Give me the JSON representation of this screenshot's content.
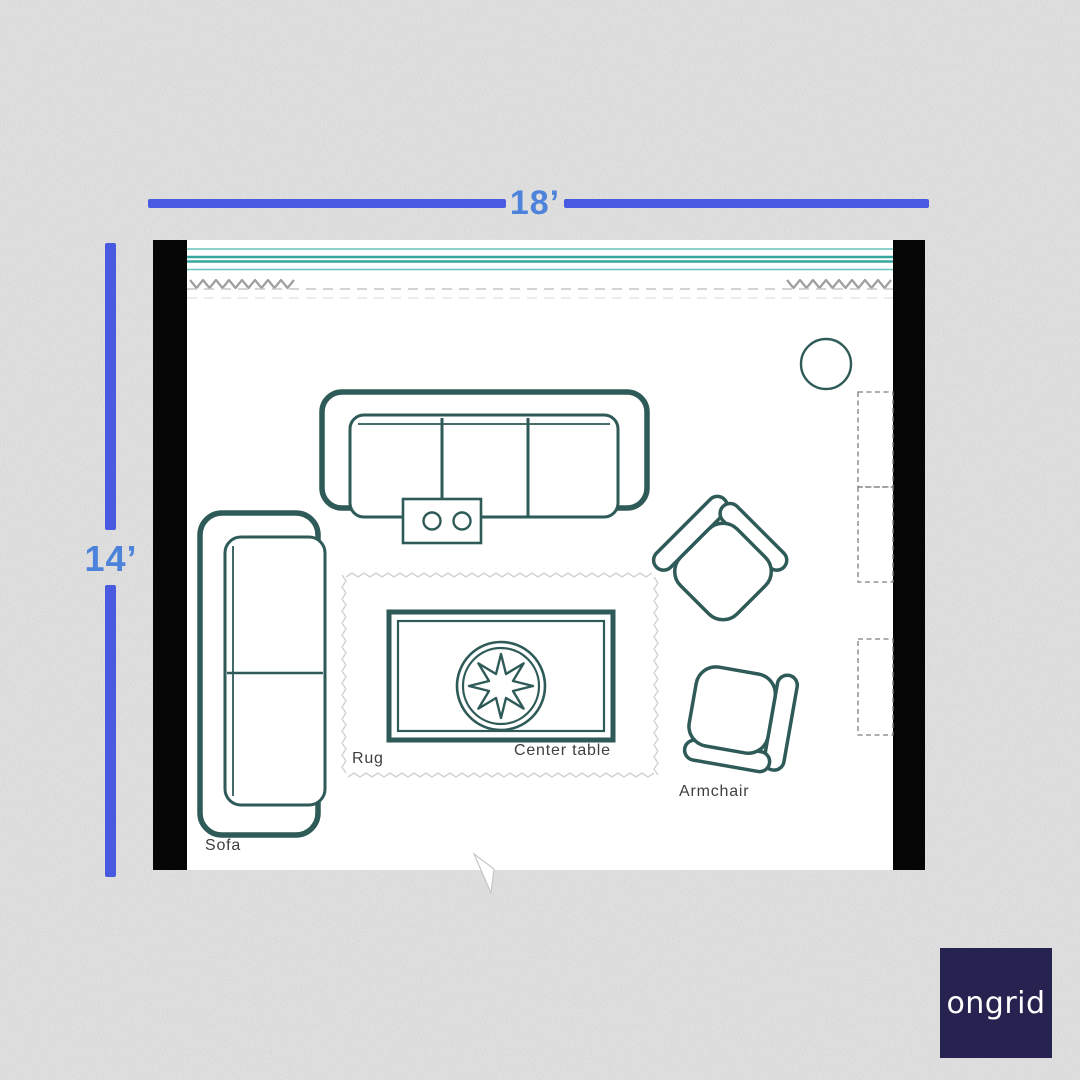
{
  "poster": {
    "dimension_labels": {
      "width": "18’",
      "height": "14’"
    },
    "room_labels": {
      "sofa": "Sofa",
      "rug": "Rug",
      "center_table": "Center table",
      "armchair": "Armchair"
    },
    "logo": {
      "text": "ongrid"
    },
    "colors": {
      "background": "#e3e3e3",
      "dimension_bar": "#4a5ae0",
      "dimension_text": "#4d83da",
      "furniture_outline": "#2e5a57",
      "window_glass_dark": "#35a69f",
      "window_glass_light": "#66c2bc",
      "wall": "#050505",
      "logo_background": "#262350"
    }
  }
}
